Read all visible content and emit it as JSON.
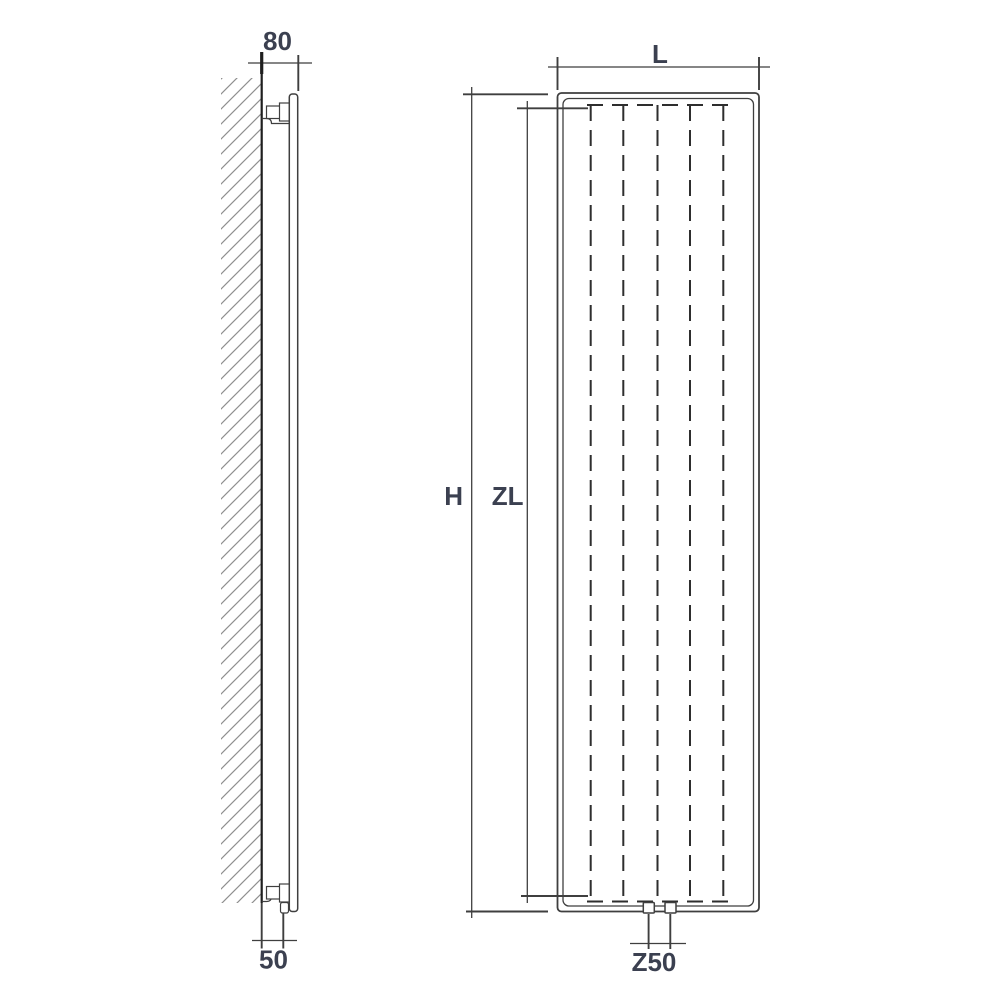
{
  "colors": {
    "background": "#ffffff",
    "line": "#3f3f3f",
    "wall": "#1f1f1f",
    "hatch": "#8f8f8f",
    "dash": "#2e2e2e",
    "text": "#3b4050"
  },
  "side_view": {
    "wall_offset_label": "80",
    "pipe_offset_label": "50"
  },
  "front_view": {
    "width_label": "L",
    "height_label": "H",
    "zone_length_label": "ZL",
    "connection_spacing_label": "Z50",
    "fin_line_count": 5,
    "bottom_connection_count": 2
  }
}
